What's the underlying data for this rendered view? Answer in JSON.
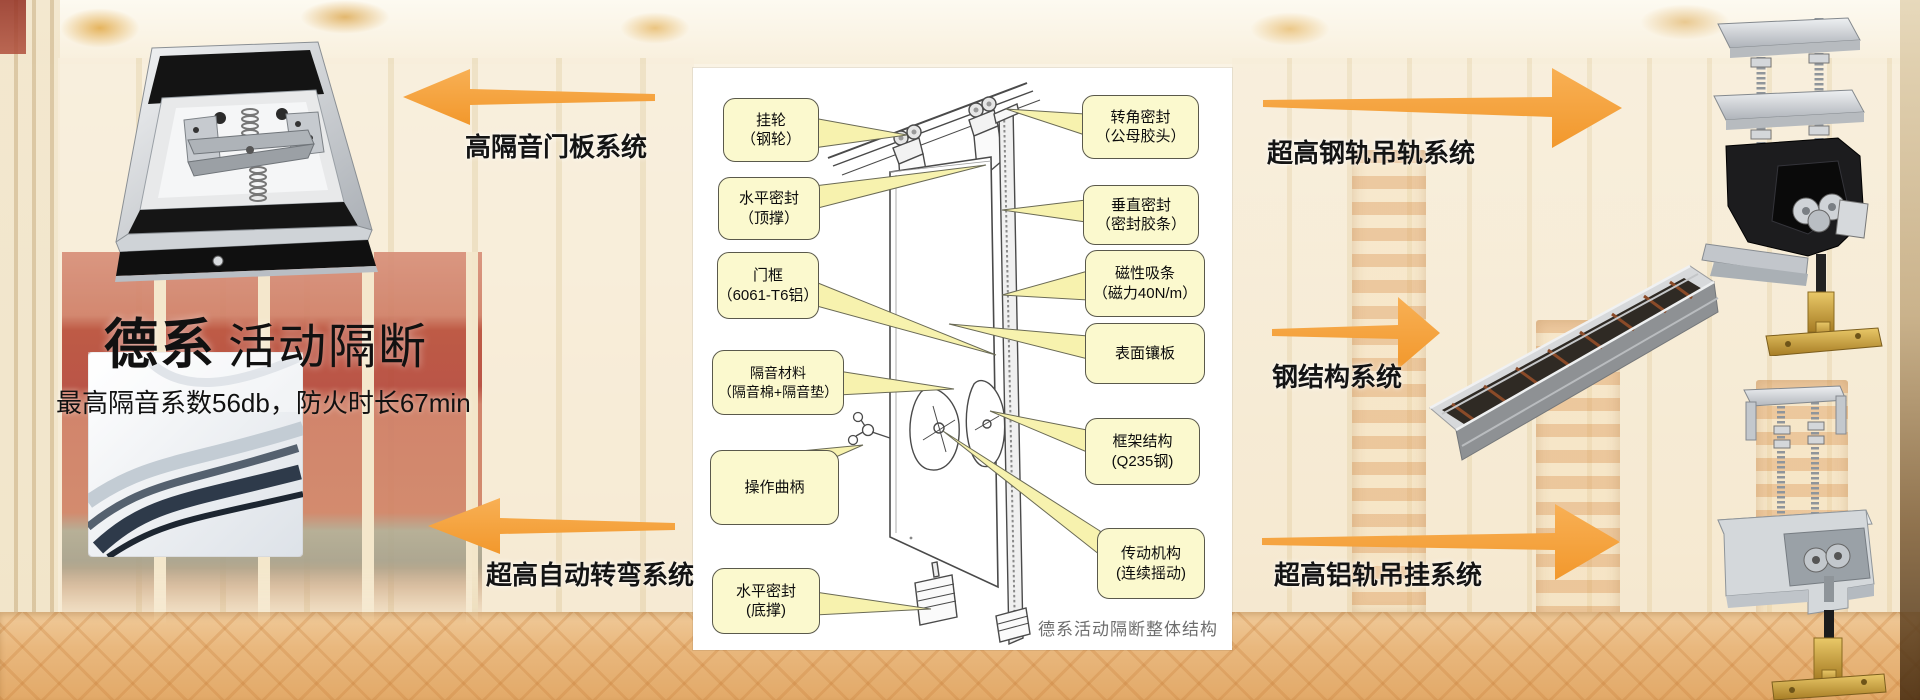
{
  "slide": {
    "title_primary": "德系",
    "title_secondary": "活动隔断",
    "subtitle": "最高隔音系数56db，防火时长67min"
  },
  "diagram": {
    "caption": "德系活动隔断整体结构",
    "left_callouts": [
      {
        "line1": "挂轮",
        "line2": "（钢轮）"
      },
      {
        "line1": "水平密封",
        "line2": "（顶撑）"
      },
      {
        "line1": "门框",
        "line2": "（6061-T6铝）"
      },
      {
        "line1": "隔音材料",
        "line2": "（隔音棉+隔音垫）"
      },
      {
        "line1": "操作曲柄",
        "line2": ""
      },
      {
        "line1": "水平密封",
        "line2": "(底撑)"
      }
    ],
    "right_callouts": [
      {
        "line1": "转角密封",
        "line2": "（公母胶头）"
      },
      {
        "line1": "垂直密封",
        "line2": "（密封胶条）"
      },
      {
        "line1": "磁性吸条",
        "line2": "（磁力40N/m）"
      },
      {
        "line1": "表面镶板",
        "line2": ""
      },
      {
        "line1": "框架结构",
        "line2": "(Q235钢)"
      },
      {
        "line1": "传动机构",
        "line2": "(连续摇动)"
      }
    ]
  },
  "system_labels": {
    "door_panel": "高隔音门板系统",
    "auto_turn": "超高自动转弯系统",
    "steel_track": "超高钢轨吊轨系统",
    "steel_structure": "钢结构系统",
    "aluminum_track": "超高铝轨吊挂系统"
  },
  "colors": {
    "arrow_orange": "#F5A140",
    "callout_fill": "#FBF9CE",
    "callout_border": "#5A594B",
    "panel_background": "#FFFFFF"
  }
}
